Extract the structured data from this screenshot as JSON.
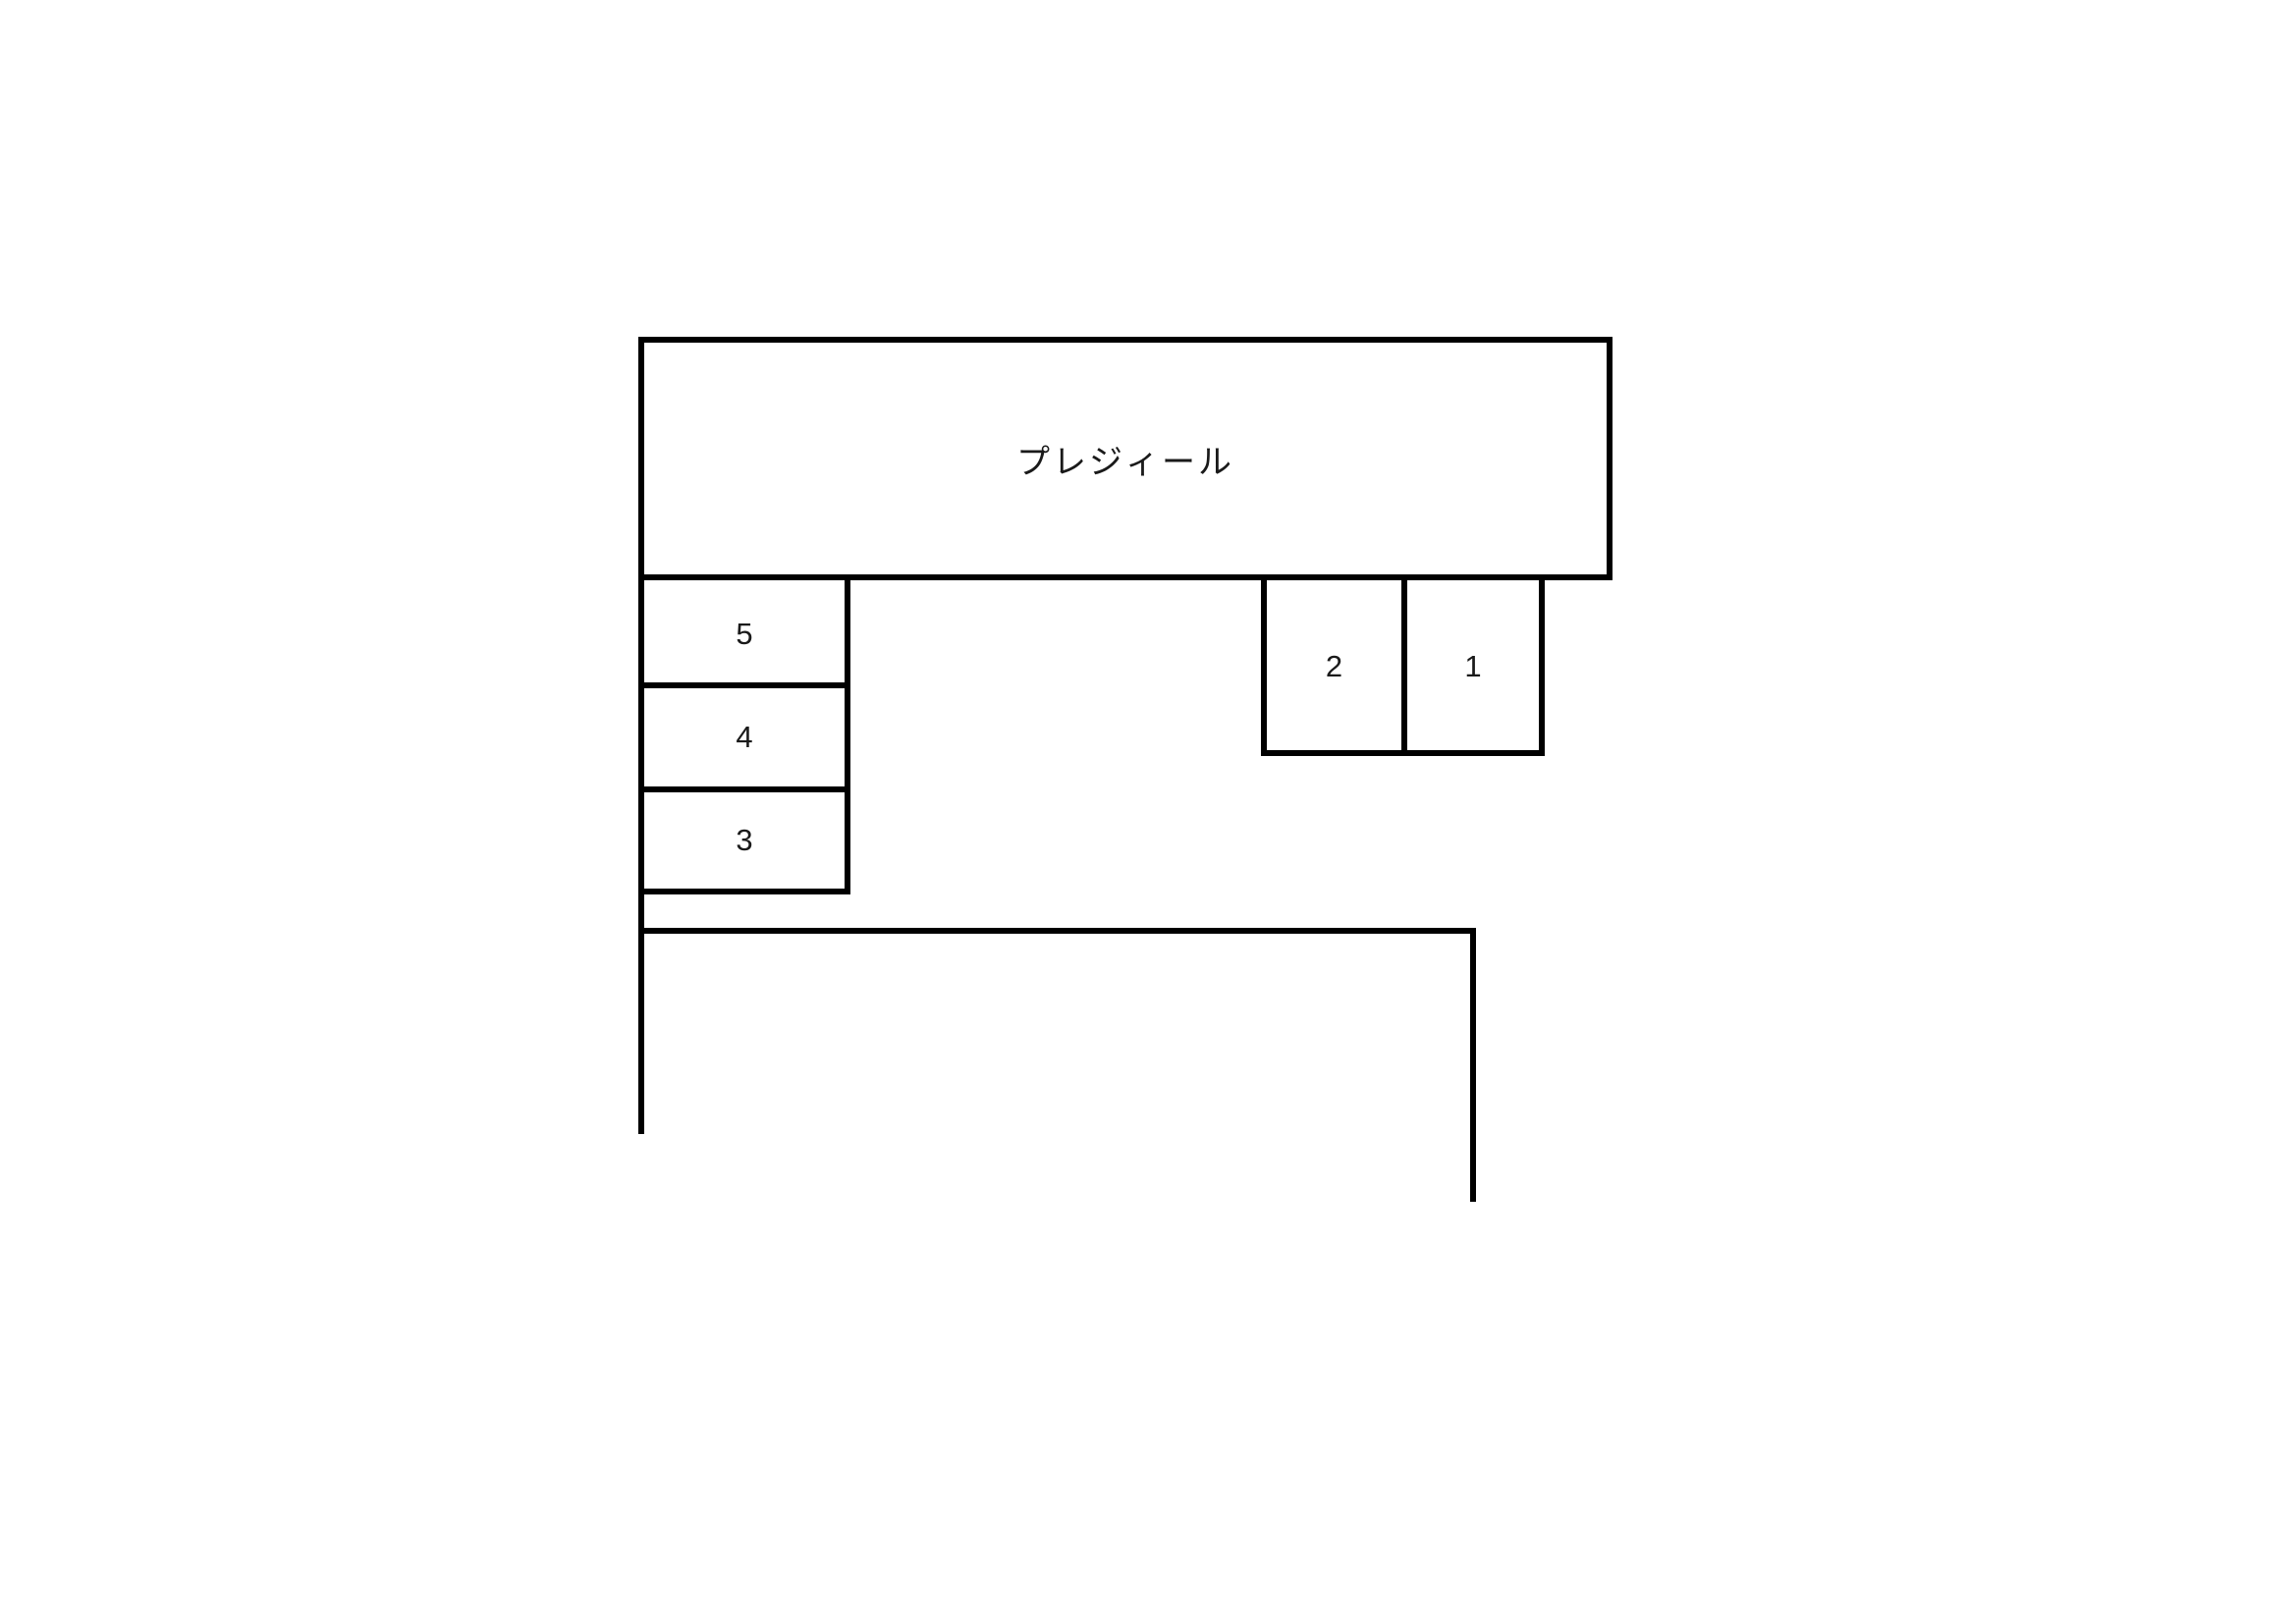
{
  "diagram": {
    "title": "parking-layout-map",
    "building": {
      "label": "プレジィール"
    },
    "parking": {
      "spaces": [
        {
          "label": "5"
        },
        {
          "label": "4"
        },
        {
          "label": "3"
        },
        {
          "label": "2"
        },
        {
          "label": "1"
        }
      ]
    },
    "colors": {
      "line": "#000000",
      "background": "#ffffff",
      "text": "#1a1a1a"
    }
  }
}
